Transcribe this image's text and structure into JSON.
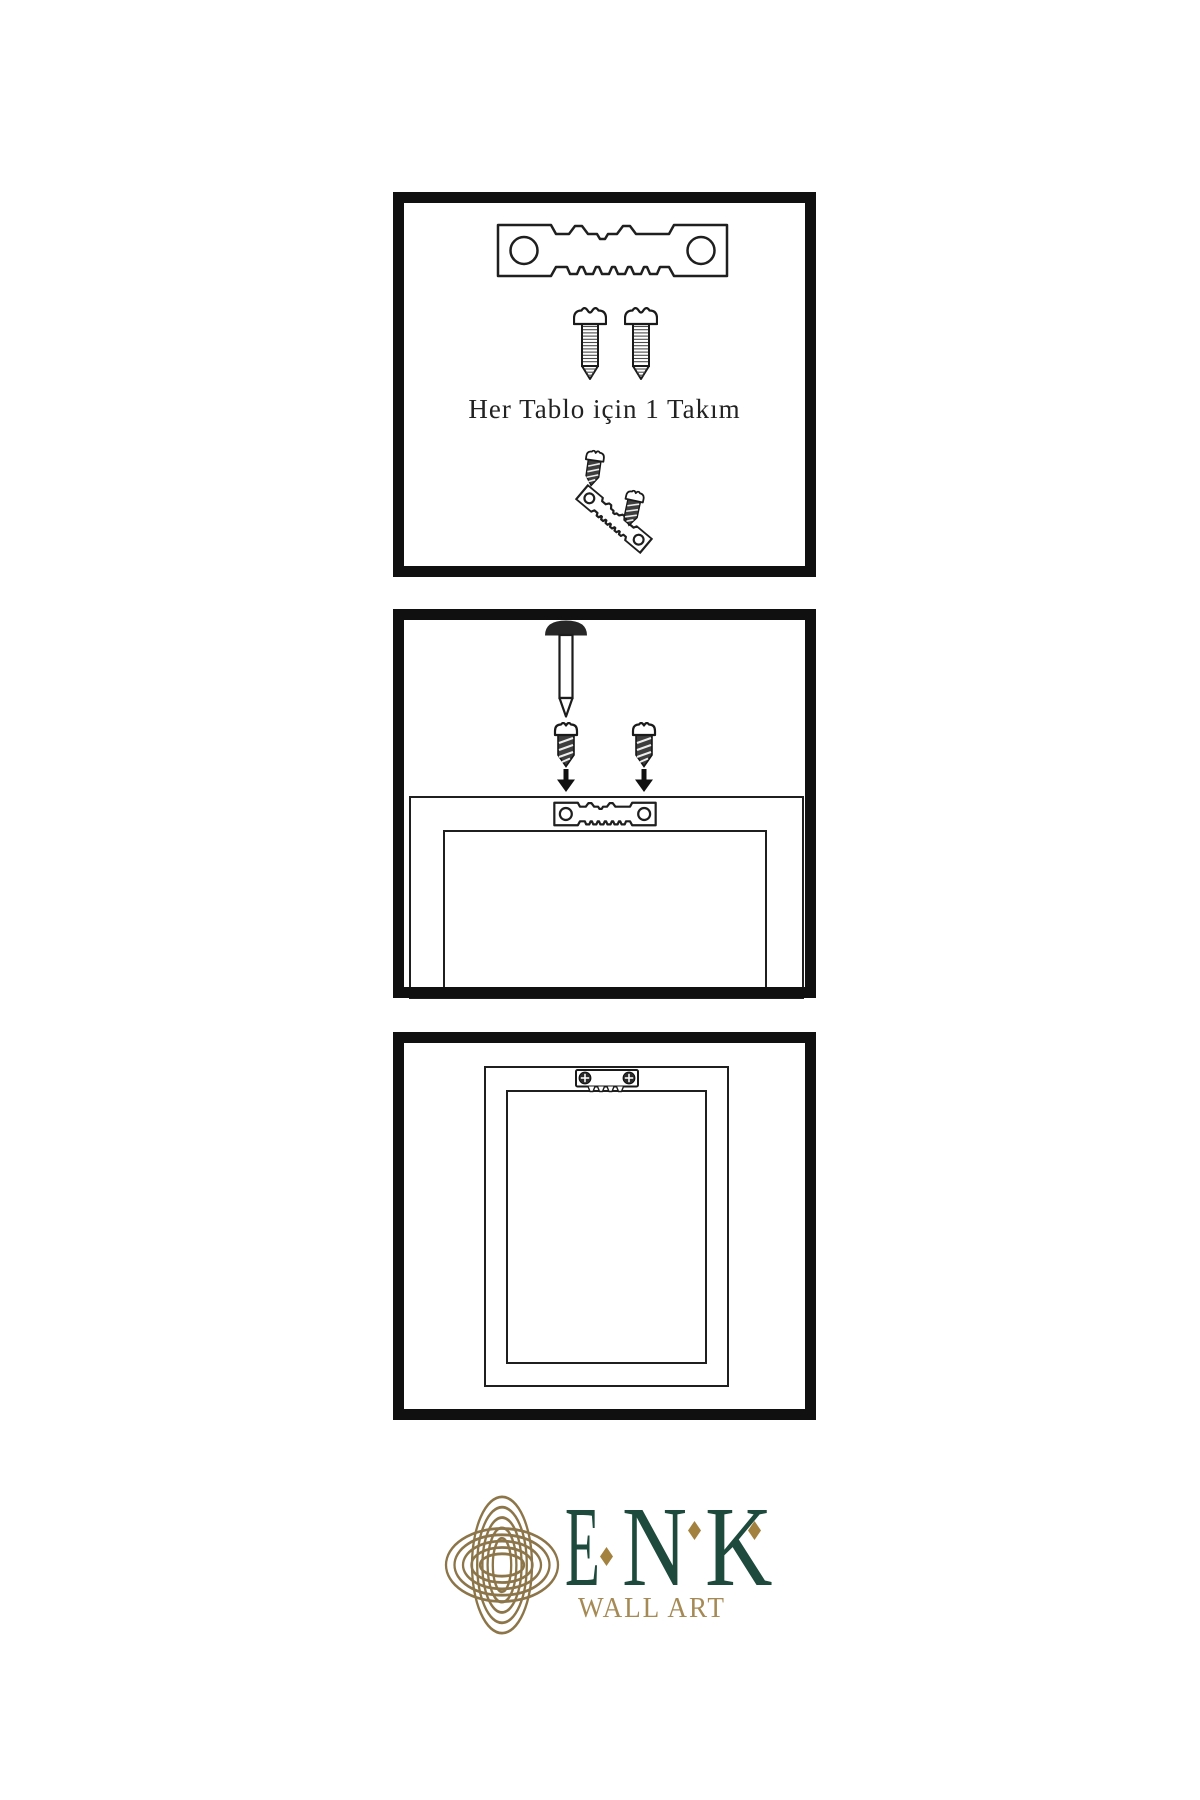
{
  "panel1": {
    "caption": "Her Tablo için 1 Takım"
  },
  "logo": {
    "letters": [
      "E",
      "N",
      "K"
    ],
    "subtitle": "WALL ART"
  },
  "colors": {
    "background": "#ffffff",
    "line": "#1f1f1f",
    "panel_border": "#101010",
    "logo_green": "#1d4a3c",
    "logo_knot_gold": "#8c7548",
    "logo_diamond_gold": "#a3813f",
    "logo_subtitle_gold": "#a58a55"
  }
}
